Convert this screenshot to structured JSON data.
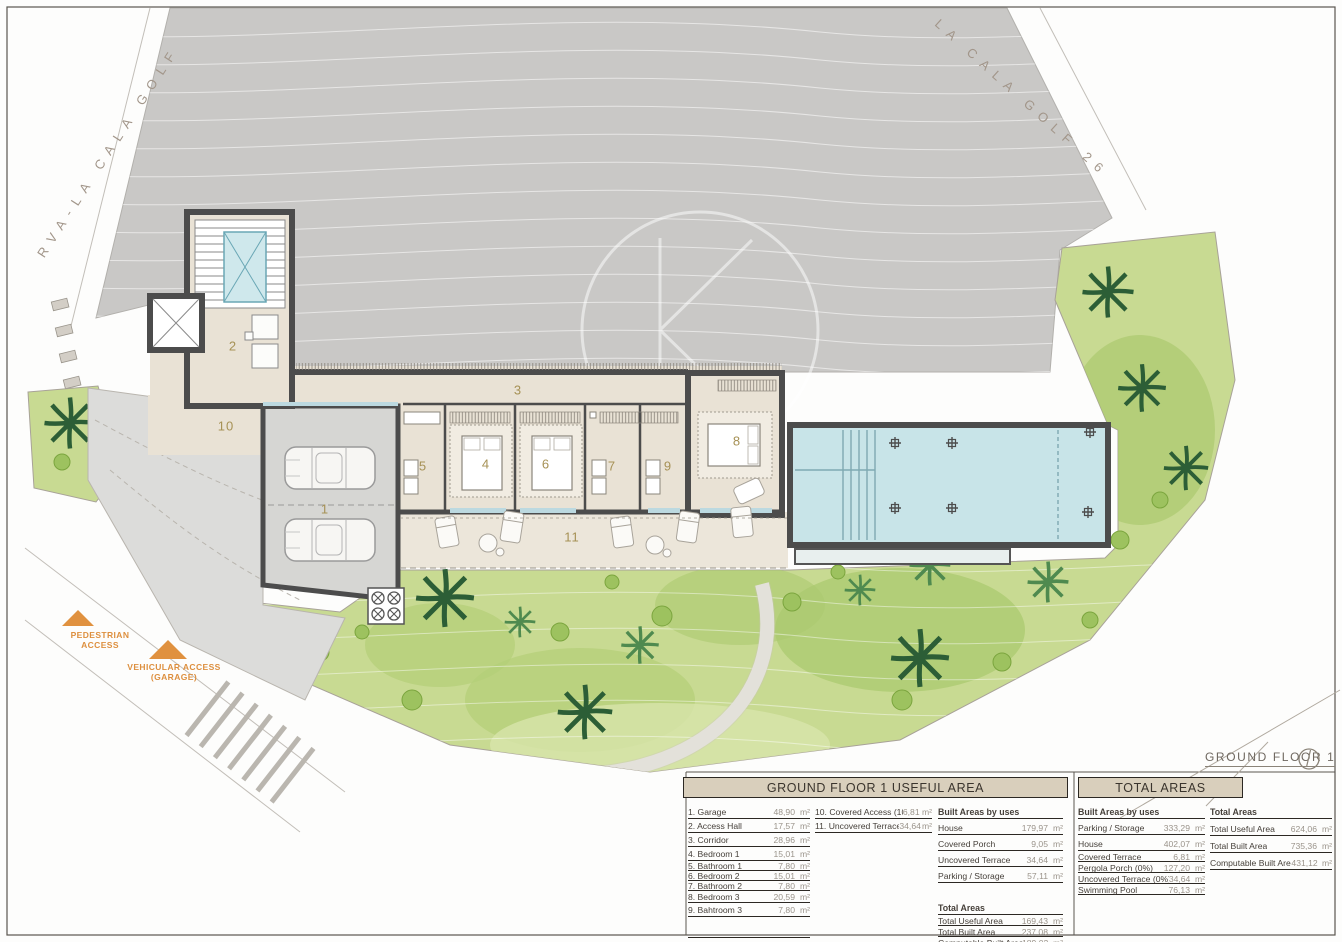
{
  "unit": "m²",
  "streets": {
    "left": "RVA-LA CALA GOLF",
    "right": "LA CALA GOLF 26"
  },
  "access": {
    "pedestrian": "PEDESTRIAN\nACCESS",
    "vehicular": "VEHICULAR ACCESS\n(GARAGE)"
  },
  "floor_label": "GROUND FLOOR 1",
  "plan": {
    "room_numbers": [
      "1",
      "2",
      "3",
      "4",
      "5",
      "6",
      "7",
      "8",
      "9",
      "10",
      "11"
    ]
  },
  "colors": {
    "terrain": "#c9c8c6",
    "green": "#c8da92",
    "pool": "#c8e4e8",
    "wall": "#4c4c4c",
    "accent_orange": "#dd8f3e",
    "table_header_bg": "#d9cfbc"
  },
  "tables": {
    "ground_floor": {
      "title": "GROUND FLOOR 1 USEFUL AREA",
      "rooms": [
        {
          "label": "1. Garage",
          "value": "48,90"
        },
        {
          "label": "2. Access Hall",
          "value": "17,57"
        },
        {
          "label": "3. Corridor",
          "value": "28,96"
        },
        {
          "label": "4. Bedroom 1",
          "value": "15,01"
        },
        {
          "label": "5. Bathroom 1",
          "value": "7,80"
        },
        {
          "label": "6. Bedroom 2",
          "value": "15,01"
        },
        {
          "label": "7. Bathroom 2",
          "value": "7,80"
        },
        {
          "label": "8. Bedroom 3",
          "value": "20,59"
        },
        {
          "label": "9. Bahtroom 3",
          "value": "7,80"
        }
      ],
      "extras": [
        {
          "label": "10. Covered Access (100%)",
          "value": "6,81"
        },
        {
          "label": "11. Uncovered Terrace 1 (0%)",
          "value": "34,64"
        }
      ],
      "built_header": "Built Areas by uses",
      "built": [
        {
          "label": "House",
          "value": "179,97"
        },
        {
          "label": "Covered Porch",
          "value": "9,05"
        },
        {
          "label": "Uncovered Terrace",
          "value": "34,64"
        },
        {
          "label": "Parking / Storage",
          "value": "57,11"
        }
      ],
      "totals_header": "Total Areas",
      "totals": [
        {
          "label": "Total Useful Area",
          "value": "169,43"
        },
        {
          "label": "Total Built Area",
          "value": "237,08"
        },
        {
          "label": "Computable Built Area",
          "value": "189,02"
        }
      ]
    },
    "total_areas": {
      "title": "TOTAL AREAS",
      "built_header": "Built Areas by uses",
      "built": [
        {
          "label": "Parking / Storage",
          "value": "333,29"
        },
        {
          "label": "House",
          "value": "402,07"
        },
        {
          "label": "Covered Terrace",
          "value": "6,81"
        },
        {
          "label": "Pergola Porch (0%)",
          "value": "127,20"
        },
        {
          "label": "Uncovered Terrace (0%)",
          "value": "34,64"
        },
        {
          "label": "Swimming Pool",
          "value": "76,13"
        }
      ],
      "totals_header": "Total Areas",
      "totals": [
        {
          "label": "Total Useful Area",
          "value": "624,06"
        },
        {
          "label": "Total Built Area",
          "value": "735,36"
        },
        {
          "label": "Computable Built Area",
          "value": "431,12"
        }
      ]
    }
  }
}
